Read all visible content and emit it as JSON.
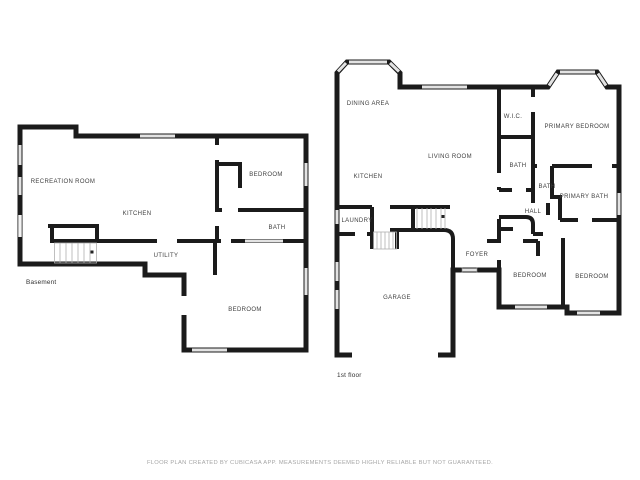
{
  "basement": {
    "floor_label": "Basement",
    "rooms": [
      {
        "label": "RECREATION ROOM"
      },
      {
        "label": "KITCHEN"
      },
      {
        "label": "BEDROOM"
      },
      {
        "label": "BATH"
      },
      {
        "label": "UTILITY"
      },
      {
        "label": "BEDROOM"
      }
    ]
  },
  "first_floor": {
    "floor_label": "1st floor",
    "rooms": [
      {
        "label": "DINING AREA"
      },
      {
        "label": "KITCHEN"
      },
      {
        "label": "LIVING ROOM"
      },
      {
        "label": "LAUNDRY"
      },
      {
        "label": "W.I.C."
      },
      {
        "label": "BATH"
      },
      {
        "label": "PRIMARY BEDROOM"
      },
      {
        "label": "BATH"
      },
      {
        "label": "PRIMARY BATH"
      },
      {
        "label": "HALL"
      },
      {
        "label": "FOYER"
      },
      {
        "label": "GARAGE"
      },
      {
        "label": "BEDROOM"
      },
      {
        "label": "BEDROOM"
      }
    ]
  },
  "footer": {
    "disclaimer": "FLOOR PLAN CREATED BY CUBICASA APP. MEASUREMENTS DEEMED HIGHLY RELIABLE BUT NOT GUARANTEED."
  },
  "colors": {
    "wall": "#1b1b1b",
    "window": "#e3e3e3",
    "label": "#3f3f3f",
    "disclaimer": "#a6a6a6"
  }
}
